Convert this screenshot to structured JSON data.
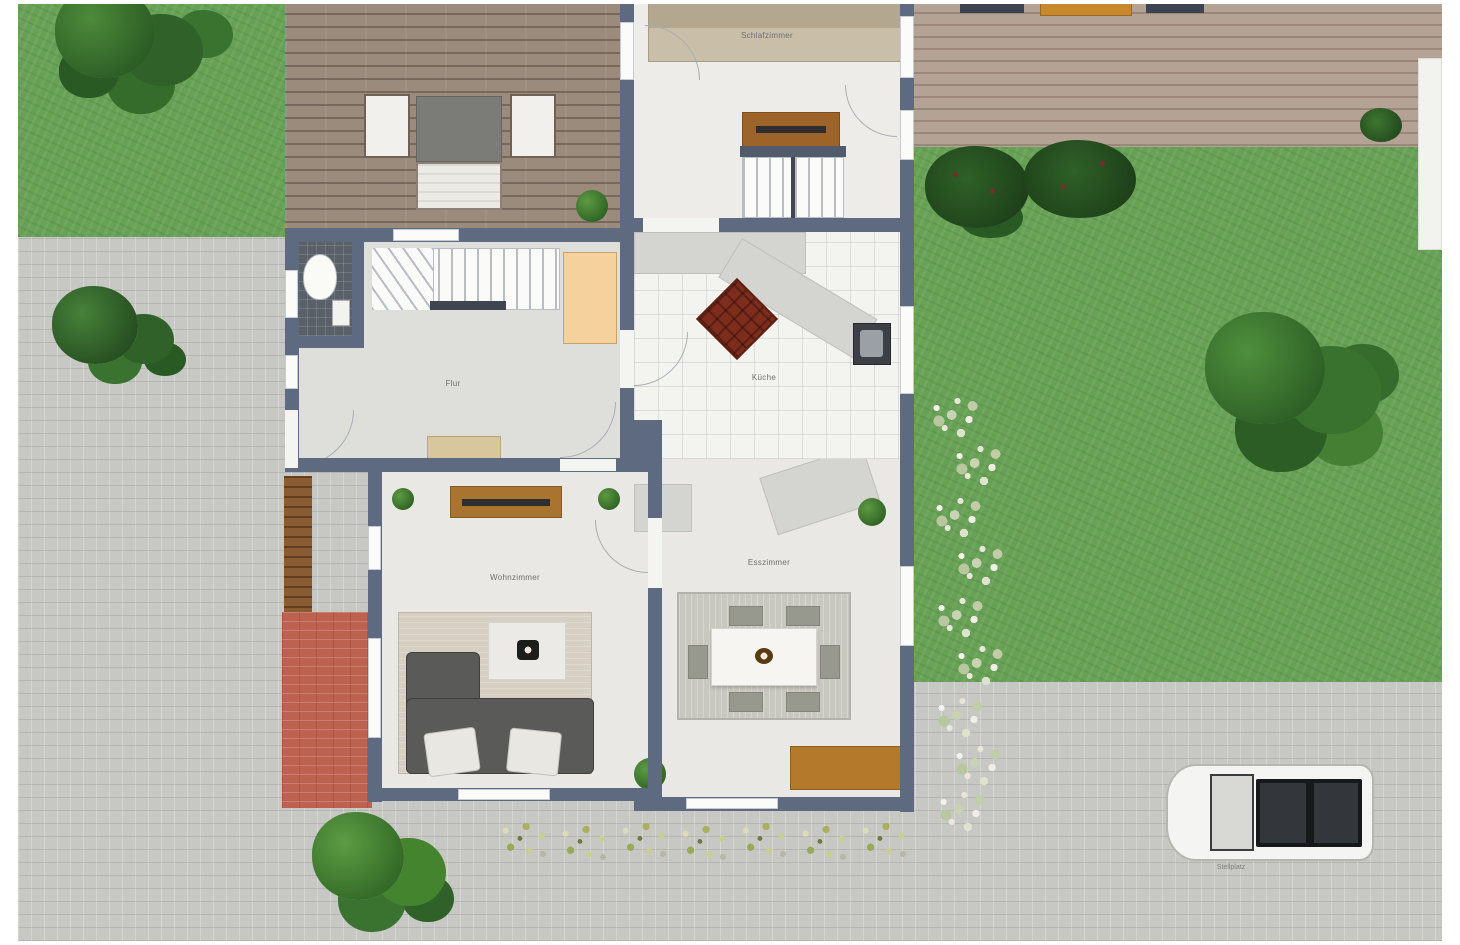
{
  "plan": {
    "rooms": {
      "bedroom": {
        "label": "Schlafzimmer"
      },
      "hall": {
        "label": "Flur"
      },
      "kitchen": {
        "label": "Küche"
      },
      "dining": {
        "label": "Esszimmer"
      },
      "living": {
        "label": "Wohnzimmer"
      }
    },
    "outdoor": {
      "parking_label": "Stellplatz"
    },
    "colors": {
      "wall": "#5e6a80",
      "grass": "#67a155",
      "paver": "#c7c7c4",
      "deck_dark": "#9a8b7c",
      "deck_light": "#b4a294",
      "brick_patio": "#bd6150",
      "wood_furniture": "#a8742f",
      "kitchen_island": "#7e2c1c",
      "window": "#fbfbf9",
      "rug_beige": "#d6cfc2",
      "sofa_gray": "#5a5a58",
      "car_roof": "#2f3135"
    }
  }
}
